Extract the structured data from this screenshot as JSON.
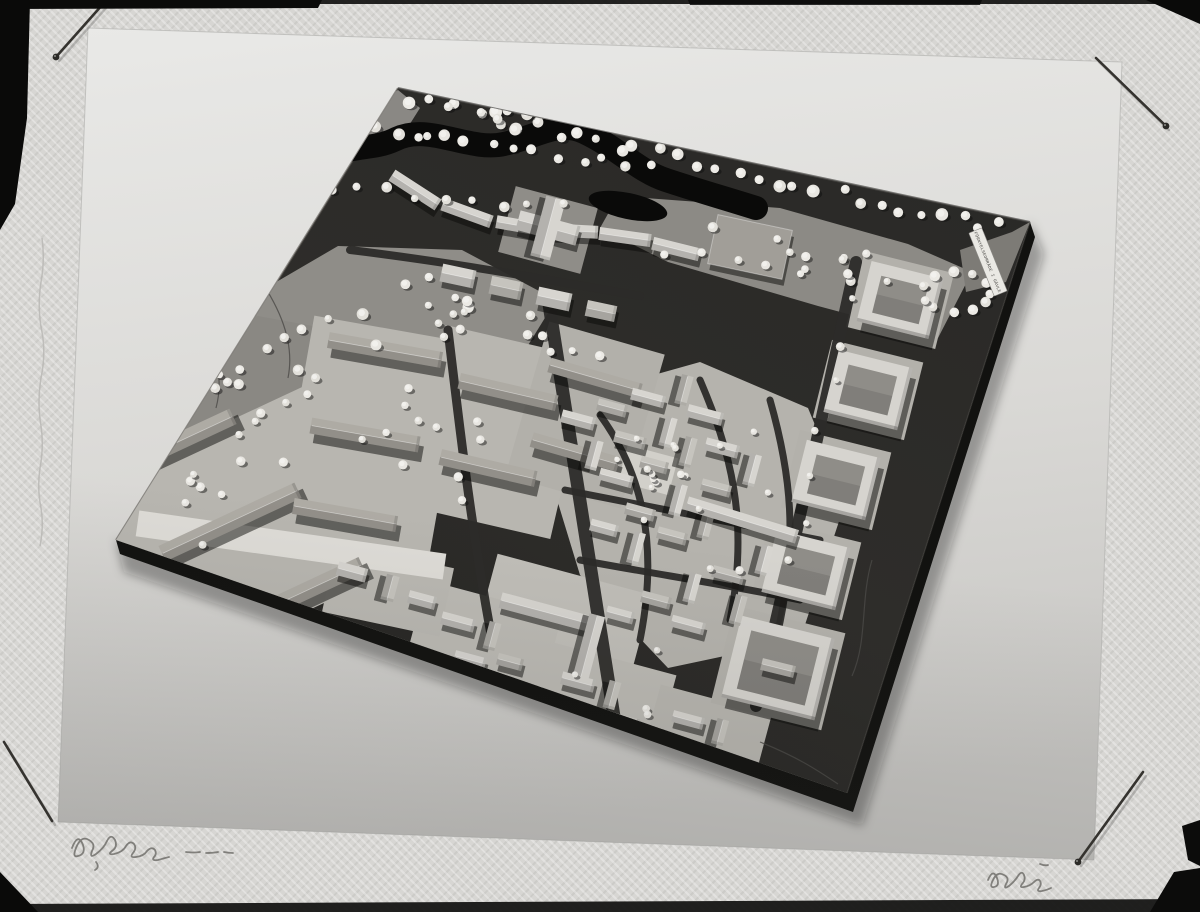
{
  "photo": {
    "model_label": "FÖRNYELSEOMRÅDE I GÄVLE"
  },
  "scene": {
    "paper_points": "88,28 1122,62 1094,860 58,822",
    "board_points": "398,88 1030,222 847,793 116,540",
    "board": {
      "side_pts": "116,540 847,793 1030,222 1035,237 853,812 120,554",
      "shadow_pts": "116,540 847,793 1030,222 1044,254 862,826 124,572"
    },
    "palette": {
      "board_light": "#343330",
      "board_dark": "#1f1e1c",
      "board_side": "#121210",
      "park": "#8f8d88",
      "park2": "#8a8883",
      "park3": "#8c8a85",
      "yard": "#b8b6b0",
      "yard_dark": "#b2b0aa",
      "oldtown": "#b5b3ad",
      "street": "#2c2b29",
      "river": "#0a0a09",
      "b_top": "#d7d5d0",
      "b_mid": "#c6c4be",
      "b_dark": "#a19e98",
      "b_wood": "#aeaba4",
      "court": "#d6d4cf",
      "white_strip": "#dedcd7",
      "tree": "#e8e6e1",
      "tree_hi": "#f3f2ee",
      "pin": "#35332f",
      "pencil": "#63615e",
      "mark": "#0c0c0b"
    },
    "edges": [
      [
        398,
        88,
        1030,
        222,
        "#4a4946",
        2,
        0.7
      ],
      [
        398,
        88,
        116,
        540,
        "#56544f",
        2,
        0.6
      ],
      [
        1030,
        222,
        847,
        793,
        "#454340",
        1.5,
        0.5
      ]
    ],
    "ground_polys": [
      {
        "pts": "242,302 338,246 462,250 556,300 514,368 372,402 266,362",
        "fill": "#8f8d88"
      },
      {
        "pts": "148,358 258,316 378,338 418,408 298,458 172,434",
        "fill": "#8a8883"
      },
      {
        "pts": "618,196 780,208 908,244 972,272 938,338 818,306 668,262 600,228",
        "fill": "#8c8a85"
      },
      {
        "pts": "558,402 700,362 808,408 846,500 800,640 668,668 580,575 548,470",
        "fill": "#b5b3ad"
      },
      {
        "pts": "352,120 398,90 420,108 396,146 362,152",
        "fill": "#8a8884"
      },
      {
        "pts": "960,250 1012,232 1030,222 1006,282 966,292",
        "fill": "#7d7b76"
      }
    ],
    "yards": [
      [
        238,
        530,
        285,
        205,
        -25,
        "#b8b6b0"
      ],
      [
        372,
        435,
        155,
        215,
        10,
        "#b8b6b0"
      ],
      [
        498,
        432,
        150,
        185,
        13,
        "#b8b6b0"
      ],
      [
        585,
        415,
        120,
        160,
        16,
        "#b2b0aa"
      ],
      [
        560,
        630,
        160,
        115,
        15,
        "#c0beb8"
      ],
      [
        482,
        644,
        140,
        95,
        15,
        "#bcbab4"
      ],
      [
        602,
        702,
        130,
        90,
        15,
        "#bcbab4"
      ],
      [
        706,
        738,
        115,
        80,
        15,
        "#b8b6b0"
      ],
      [
        388,
        590,
        120,
        70,
        12,
        "#bab8b2"
      ],
      [
        548,
        230,
        85,
        68,
        15,
        "#8f8d88"
      ],
      [
        900,
        300,
        92,
        78,
        14,
        "#b3b1ab"
      ],
      [
        868,
        390,
        94,
        80,
        14,
        "#b3b1ab"
      ],
      [
        836,
        480,
        94,
        80,
        14,
        "#b3b1ab"
      ],
      [
        806,
        570,
        94,
        80,
        14,
        "#b3b1ab"
      ],
      [
        778,
        668,
        114,
        100,
        14,
        "#b3b1ab"
      ],
      [
        291,
        545,
        310,
        26,
        8,
        "#dedcd7"
      ],
      [
        648,
        470,
        52,
        38,
        15,
        "#d2d0ca"
      ]
    ],
    "streets": [
      {
        "d": "M448,330 C460,430 470,520 492,640",
        "w": 9
      },
      {
        "d": "M548,298 C566,420 590,560 618,742",
        "w": 13
      },
      {
        "d": "M856,262 C830,380 800,520 756,706",
        "w": 12
      },
      {
        "d": "M600,415 C640,470 660,540 640,640",
        "w": 7
      },
      {
        "d": "M700,380 C730,450 750,520 730,620",
        "w": 7
      },
      {
        "d": "M770,400 C790,470 800,540 776,640",
        "w": 7
      },
      {
        "d": "M565,490 C640,505 720,520 820,540",
        "w": 7
      },
      {
        "d": "M580,560 C660,575 730,585 800,600",
        "w": 7
      },
      {
        "d": "M150,560 C300,612 420,650 520,688",
        "w": 10
      },
      {
        "d": "M350,250 C450,262 550,280 640,296",
        "w": 8
      }
    ],
    "contours": [
      "M872,560 C860,600 868,640 852,676",
      "M300,648 C380,686 460,706 540,734",
      "M248,262 C276,300 296,338 288,378",
      "M760,742 C800,758 820,772 838,784",
      "M196,320 C216,348 224,378 216,408"
    ],
    "river": {
      "d": "M318,168 C340,142 368,152 394,140 C428,122 468,152 504,144 C540,136 558,120 584,132 C618,148 640,172 666,180 C696,190 724,198 756,208",
      "w": 24,
      "lagoon": [
        628,
        206,
        40,
        13,
        12
      ]
    },
    "buildings": [
      [
        165,
        448,
        150,
        17,
        -25,
        3
      ],
      [
        230,
        522,
        150,
        17,
        -25,
        3
      ],
      [
        295,
        596,
        148,
        17,
        -25,
        3
      ],
      [
        385,
        350,
        115,
        16,
        10,
        3
      ],
      [
        365,
        435,
        110,
        16,
        10,
        3
      ],
      [
        345,
        515,
        105,
        16,
        10,
        3
      ],
      [
        508,
        392,
        100,
        16,
        13,
        3
      ],
      [
        488,
        468,
        98,
        16,
        13,
        3
      ],
      [
        595,
        378,
        95,
        15,
        16,
        3
      ],
      [
        575,
        452,
        90,
        15,
        16,
        3
      ],
      [
        415,
        190,
        55,
        13,
        33,
        0
      ],
      [
        467,
        213,
        52,
        13,
        20,
        0
      ],
      [
        521,
        226,
        50,
        13,
        10,
        0
      ],
      [
        573,
        231,
        50,
        13,
        3,
        0
      ],
      [
        625,
        237,
        52,
        13,
        8,
        0
      ],
      [
        676,
        249,
        48,
        13,
        14,
        0
      ],
      [
        458,
        276,
        34,
        18,
        12,
        0
      ],
      [
        506,
        288,
        32,
        18,
        12,
        1
      ],
      [
        554,
        299,
        34,
        18,
        12,
        0
      ],
      [
        601,
        311,
        30,
        16,
        12,
        1
      ],
      [
        548,
        228,
        62,
        20,
        15,
        0
      ],
      [
        548,
        228,
        62,
        20,
        105,
        0
      ],
      [
        750,
        247,
        76,
        50,
        12,
        2
      ],
      [
        545,
        612,
        92,
        16,
        15,
        0
      ],
      [
        588,
        650,
        72,
        16,
        105,
        0
      ],
      [
        578,
        420,
        34,
        13,
        15,
        0
      ],
      [
        612,
        408,
        30,
        12,
        15,
        1
      ],
      [
        648,
        398,
        34,
        12,
        15,
        0
      ],
      [
        684,
        390,
        30,
        12,
        105,
        1
      ],
      [
        705,
        415,
        36,
        13,
        15,
        0
      ],
      [
        668,
        432,
        30,
        12,
        105,
        0
      ],
      [
        630,
        440,
        32,
        12,
        15,
        1
      ],
      [
        594,
        455,
        30,
        12,
        105,
        0
      ],
      [
        616,
        478,
        34,
        12,
        15,
        0
      ],
      [
        654,
        465,
        28,
        12,
        15,
        1
      ],
      [
        688,
        452,
        30,
        12,
        105,
        1
      ],
      [
        722,
        448,
        34,
        13,
        15,
        0
      ],
      [
        752,
        470,
        32,
        12,
        105,
        0
      ],
      [
        716,
        488,
        30,
        12,
        15,
        1
      ],
      [
        678,
        500,
        32,
        12,
        105,
        0
      ],
      [
        640,
        512,
        30,
        12,
        15,
        1
      ],
      [
        604,
        528,
        28,
        12,
        15,
        0
      ],
      [
        636,
        548,
        32,
        12,
        105,
        0
      ],
      [
        672,
        536,
        30,
        12,
        15,
        1
      ],
      [
        706,
        524,
        30,
        12,
        105,
        1
      ],
      [
        742,
        520,
        115,
        14,
        17,
        0
      ],
      [
        764,
        560,
        30,
        12,
        105,
        0
      ],
      [
        728,
        575,
        32,
        12,
        15,
        1
      ],
      [
        692,
        588,
        30,
        12,
        105,
        0
      ],
      [
        656,
        600,
        30,
        12,
        15,
        1
      ],
      [
        620,
        615,
        28,
        12,
        15,
        0
      ],
      [
        688,
        625,
        34,
        12,
        15,
        0
      ],
      [
        738,
        610,
        30,
        12,
        105,
        1
      ],
      [
        352,
        572,
        30,
        14,
        15,
        0
      ],
      [
        390,
        588,
        26,
        13,
        105,
        1
      ],
      [
        422,
        600,
        28,
        13,
        15,
        0
      ],
      [
        458,
        622,
        34,
        13,
        15,
        0
      ],
      [
        492,
        636,
        28,
        12,
        105,
        1
      ],
      [
        470,
        660,
        32,
        12,
        15,
        0
      ],
      [
        510,
        662,
        26,
        12,
        15,
        1
      ],
      [
        578,
        682,
        34,
        13,
        15,
        0
      ],
      [
        612,
        695,
        28,
        12,
        105,
        1
      ],
      [
        590,
        718,
        30,
        12,
        15,
        0
      ],
      [
        626,
        722,
        26,
        12,
        15,
        1
      ],
      [
        688,
        720,
        32,
        12,
        15,
        0
      ],
      [
        720,
        732,
        26,
        12,
        105,
        1
      ],
      [
        700,
        752,
        28,
        12,
        15,
        1
      ],
      [
        778,
        668,
        34,
        12,
        14,
        1
      ]
    ],
    "courtyards": [
      [
        900,
        300,
        74,
        62,
        14
      ],
      [
        868,
        390,
        76,
        64,
        14
      ],
      [
        836,
        480,
        76,
        64,
        14
      ],
      [
        806,
        570,
        76,
        64,
        14
      ],
      [
        778,
        668,
        96,
        84,
        14
      ]
    ],
    "trees": {
      "rows": [
        [
          415,
          100,
          1000,
          228,
          30,
          7,
          4,
          6.5
        ],
        [
          352,
          128,
          648,
          168,
          14,
          6,
          4,
          6
        ],
        [
          330,
          186,
          560,
          208,
          9,
          5,
          3.5,
          5.5
        ],
        [
          352,
          146,
          200,
          292,
          8,
          5,
          3.5,
          5.5
        ],
        [
          198,
          296,
          150,
          408,
          6,
          5,
          3.5,
          5
        ],
        [
          160,
          428,
          296,
          330,
          9,
          6,
          3.5,
          5.5
        ],
        [
          852,
          300,
          790,
          560,
          7,
          8,
          3,
          4.5
        ],
        [
          660,
          252,
          920,
          290,
          8,
          6,
          3.5,
          5
        ]
      ],
      "clusters": [
        [
          392,
          315,
          120,
          55,
          14,
          3.5,
          6
        ],
        [
          262,
          392,
          95,
          48,
          12,
          3.5,
          5.5
        ],
        [
          480,
          125,
          70,
          28,
          8,
          4,
          6
        ],
        [
          255,
          490,
          120,
          70,
          9,
          3.5,
          5
        ],
        [
          432,
          445,
          90,
          80,
          10,
          3.5,
          5
        ],
        [
          688,
          520,
          130,
          110,
          12,
          2.8,
          4.2
        ],
        [
          800,
          255,
          110,
          40,
          9,
          3.5,
          5.5
        ],
        [
          560,
          330,
          60,
          30,
          6,
          3.5,
          5
        ],
        [
          560,
          690,
          120,
          60,
          6,
          3,
          4.5
        ],
        [
          652,
          470,
          40,
          25,
          6,
          3,
          4
        ]
      ],
      "rings": [
        [
          956,
          292,
          34,
          11,
          4,
          5.5
        ]
      ]
    },
    "label": {
      "x": 988,
      "y": 262,
      "angle": 68
    },
    "pins": [
      [
        103,
        4,
        56,
        57,
        1
      ],
      [
        1096,
        58,
        1166,
        126,
        1
      ],
      [
        4,
        742,
        52,
        821,
        0
      ],
      [
        1143,
        772,
        1078,
        862,
        1
      ]
    ],
    "scribbles": [
      "M72,848 q6,-16 11,-3 q3,9 -5,11 q-6,2 -2,-8 q5,-13 13,-8 q7,4 3,11 q-3,8 4,3 q8,-6 11,-13 q4,-8 8,-1 q3,7 -3,11 q-5,4 2,3 q9,-2 12,-8 q4,-6 8,-2 q3,4 -1,9 q-4,5 3,4 q8,-1 11,-6 q5,-5 8,-1 q2,4 -1,7 q-3,4 4,3 q7,-2 11,-3",
      "M186,852 q8,1 14,0 M206,853 q7,0 12,-1 M224,852 q5,1 9,1",
      "M96,862 q4,5 -1,8",
      "M988,880 q5,-12 9,-2 q3,8 -3,9 q-5,1 -1,-7 q4,-9 11,-5 q6,3 2,9 q-3,6 3,2 q6,-5 9,-10 q4,-6 6,-1 q2,5 -2,9 q-3,4 2,3 q6,-1 10,-5 q4,-4 6,-1 q2,3 -1,7 q-3,4 3,3 q5,-1 9,-3",
      "M1040,864 q5,2 8,1"
    ],
    "deckle": "M42,238 q3,22 -1,44 q-4,26 1,50 q4,22 -1,46 q-4,24 0,48 q3,20 -1,42 q-3,20 1,40 q3,18 -1,38",
    "scan_marks": [
      [
        "0,0 1200,0 1200,4 0,4",
        "#0d0d0c",
        0.9
      ],
      [
        "0,0 322,0 318,8 0,9",
        "#0b0b0a",
        1
      ],
      [
        "688,0 982,0 980,5 690,5",
        "#0b0b0a",
        0.85
      ],
      [
        "0,0 30,0 27,118 15,204 0,230",
        "#0a0a09",
        1
      ],
      [
        "1146,0 1200,0 1200,24",
        "#0a0a09",
        1
      ],
      [
        "0,904 1200,899 1200,912 0,912",
        "#151514",
        0.95
      ],
      [
        "0,872 38,912 0,912",
        "#0a0a09",
        1
      ],
      [
        "1182,826 1200,820 1200,866 1188,860",
        "#0c0c0b",
        1
      ],
      [
        "1174,872 1200,868 1200,912 1150,912",
        "#0c0c0b",
        1
      ]
    ]
  }
}
